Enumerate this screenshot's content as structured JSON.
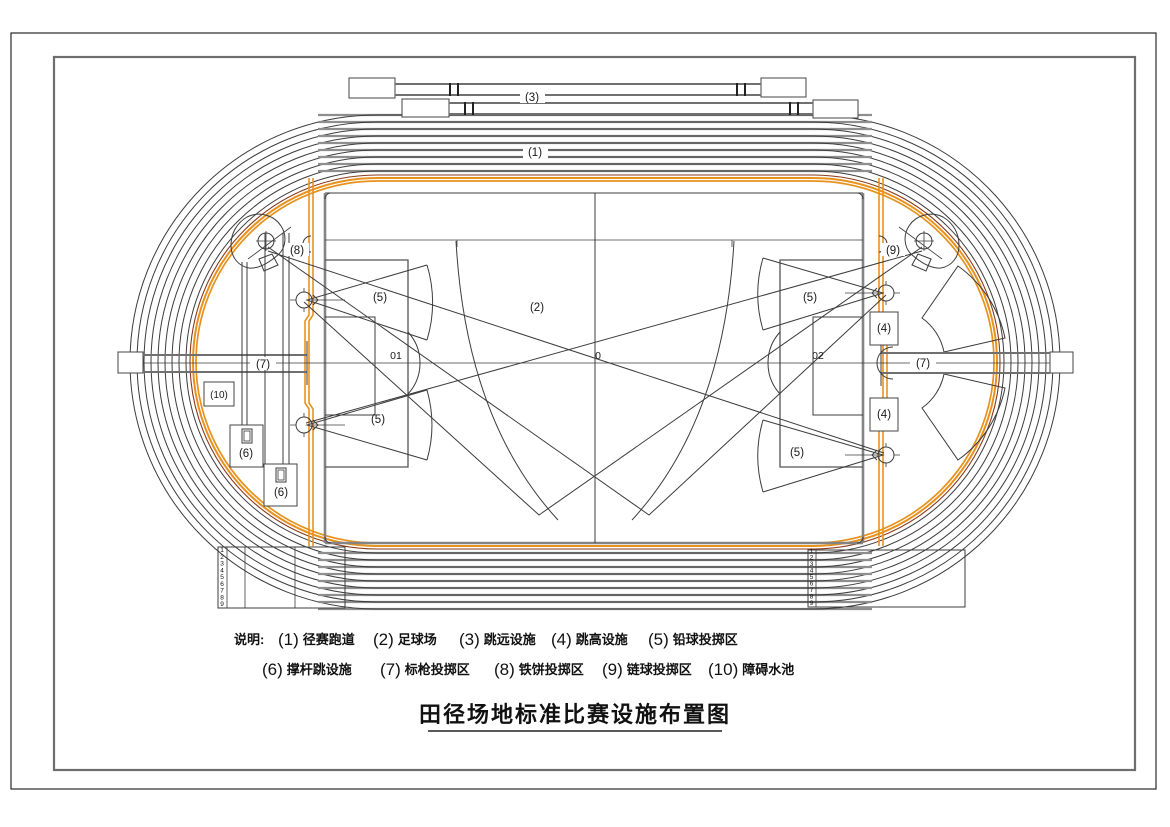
{
  "drawing": {
    "title": "田径场地标准比赛设施布置图",
    "legend": {
      "prefix": "说明:",
      "row1": [
        {
          "num": "(1)",
          "label": "径赛跑道"
        },
        {
          "num": "(2)",
          "label": "足球场"
        },
        {
          "num": "(3)",
          "label": "跳远设施"
        },
        {
          "num": "(4)",
          "label": "跳高设施"
        },
        {
          "num": "(5)",
          "label": "铅球投掷区"
        }
      ],
      "row2": [
        {
          "num": "(6)",
          "label": "撑杆跳设施"
        },
        {
          "num": "(7)",
          "label": "标枪投掷区"
        },
        {
          "num": "(8)",
          "label": "铁饼投掷区"
        },
        {
          "num": "(9)",
          "label": "链球投掷区"
        },
        {
          "num": "(10)",
          "label": "障碍水池"
        }
      ]
    },
    "callouts": {
      "track": "(1)",
      "soccer": "(2)",
      "long_jump": "(3)",
      "high_jump": "(4)",
      "shot_put": "(5)",
      "pole_vault": "(6)",
      "javelin": "(7)",
      "discus": "(8)",
      "hammer": "(9)",
      "water_pit": "(10)"
    },
    "field_marks": {
      "center": "0",
      "left_goal": "01",
      "right_goal": "02"
    },
    "lane_numbers": [
      "1",
      "2",
      "3",
      "4",
      "5",
      "6",
      "7",
      "8",
      "9"
    ],
    "colors": {
      "curb_orange": "#E8921E",
      "curb_maroon": "#8B3A1A",
      "line_dark": "#3C3C3C",
      "line_gray": "#8E8E8E",
      "field_gray": "#848484"
    }
  }
}
